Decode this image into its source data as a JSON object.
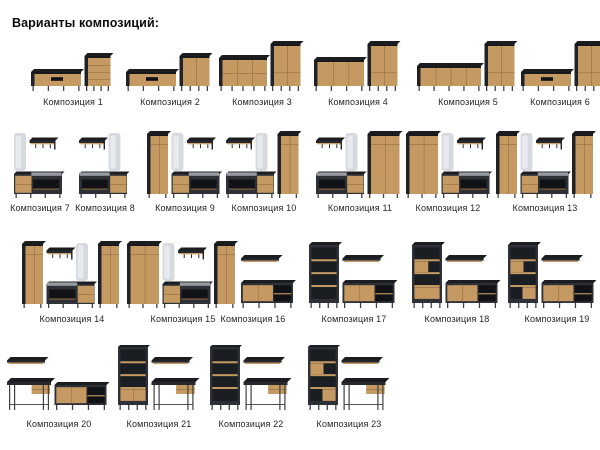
{
  "title": "Варианты композиций:",
  "colors": {
    "background": "#ffffff",
    "text": "#232528",
    "wood": "#c49a62",
    "wood_line": "#9a7443",
    "dark": "#2d3036",
    "dark_side": "#202226",
    "top_face": "#1b1d21",
    "niche": "#101215",
    "interior": "#1a1d21",
    "mirror": "#d6dade",
    "mirror_sheen": "#e8eaee",
    "seat": "#979a9f",
    "leg": "#3f4145"
  },
  "compositions": [
    {
      "label": "Композиция 1",
      "pieces": [
        "tv-stand",
        "chest"
      ]
    },
    {
      "label": "Композиция 2",
      "pieces": [
        "tv-stand",
        "cabinet"
      ]
    },
    {
      "label": "Композиция 3",
      "pieces": [
        "dresser",
        "highboard"
      ]
    },
    {
      "label": "Композиция 4",
      "pieces": [
        "sideboard",
        "highboard"
      ]
    },
    {
      "label": "Композиция 5",
      "pieces": [
        "sideboard-long",
        "highboard"
      ]
    },
    {
      "label": "Композиция 6",
      "pieces": [
        "tv-stand",
        "highboard"
      ]
    },
    {
      "label": "Композиция 7",
      "pieces": [
        "mirror",
        "coat-rack",
        "bench"
      ]
    },
    {
      "label": "Композиция 8",
      "pieces": [
        "coat-rack",
        "mirror",
        "bench-r"
      ]
    },
    {
      "label": "Композиция 9",
      "pieces": [
        "wardrobe",
        "mirror",
        "coat-rack",
        "bench"
      ]
    },
    {
      "label": "Композиция 10",
      "pieces": [
        "coat-rack",
        "mirror",
        "bench-r",
        "wardrobe"
      ]
    },
    {
      "label": "Композиция 11",
      "pieces": [
        "coat-rack",
        "mirror",
        "bench-r",
        "wardrobe-wide"
      ]
    },
    {
      "label": "Композиция 12",
      "pieces": [
        "wardrobe-wide",
        "mirror",
        "coat-rack",
        "bench"
      ]
    },
    {
      "label": "Композиция 13",
      "pieces": [
        "wardrobe",
        "mirror",
        "coat-rack",
        "bench",
        "wardrobe"
      ]
    },
    {
      "label": "Композиция 14",
      "pieces": [
        "wardrobe",
        "coat-rack",
        "mirror",
        "bench-r",
        "wardrobe"
      ]
    },
    {
      "label": "Композиция 15",
      "pieces": [
        "wardrobe-wide",
        "mirror",
        "coat-rack",
        "bench",
        "wardrobe"
      ]
    },
    {
      "label": "Композиция 16",
      "pieces": [
        "wall-shelf",
        "sideboard-open"
      ]
    },
    {
      "label": "Композиция 17",
      "pieces": [
        "bookshelf-open",
        "wall-shelf",
        "sideboard-open"
      ]
    },
    {
      "label": "Композиция 18",
      "pieces": [
        "bookshelf-box",
        "wall-shelf",
        "sideboard-open"
      ]
    },
    {
      "label": "Композиция 19",
      "pieces": [
        "bookshelf-boxes",
        "wall-shelf",
        "sideboard-open"
      ]
    },
    {
      "label": "Композиция 20",
      "pieces": [
        "wall-shelf",
        "desk",
        "sideboard-open"
      ]
    },
    {
      "label": "Композиция 21",
      "pieces": [
        "bookshelf-doors",
        "wall-shelf",
        "desk"
      ]
    },
    {
      "label": "Композиция 22",
      "pieces": [
        "bookshelf-open",
        "wall-shelf",
        "desk"
      ]
    },
    {
      "label": "Композиция 23",
      "pieces": [
        "bookshelf-boxes",
        "wall-shelf",
        "desk"
      ]
    }
  ]
}
